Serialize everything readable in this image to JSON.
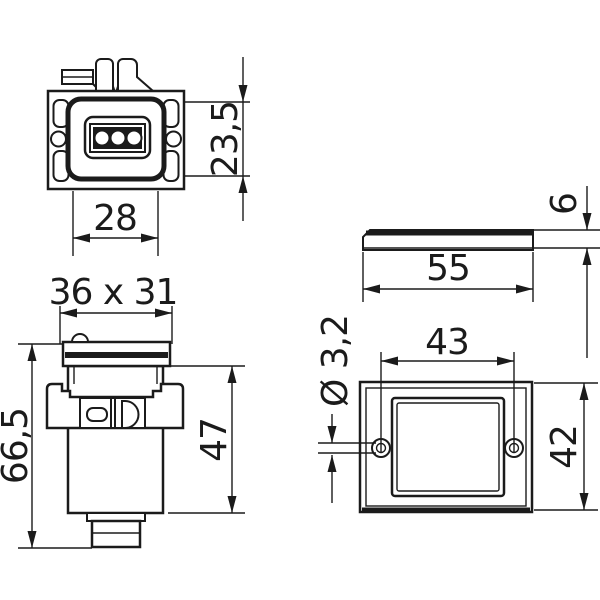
{
  "drawing": {
    "background_color": "#ffffff",
    "line_color": "#1b1b1b",
    "dimensions": {
      "front_height": "23,5",
      "front_width": "28",
      "cap_section": "36 x 31",
      "overall_length": "66,5",
      "body_length": "47",
      "cover_width": "55",
      "cover_thickness": "6",
      "hole_spacing": "43",
      "cover_height": "42",
      "hole_diameter": "Ø 3,2"
    }
  }
}
